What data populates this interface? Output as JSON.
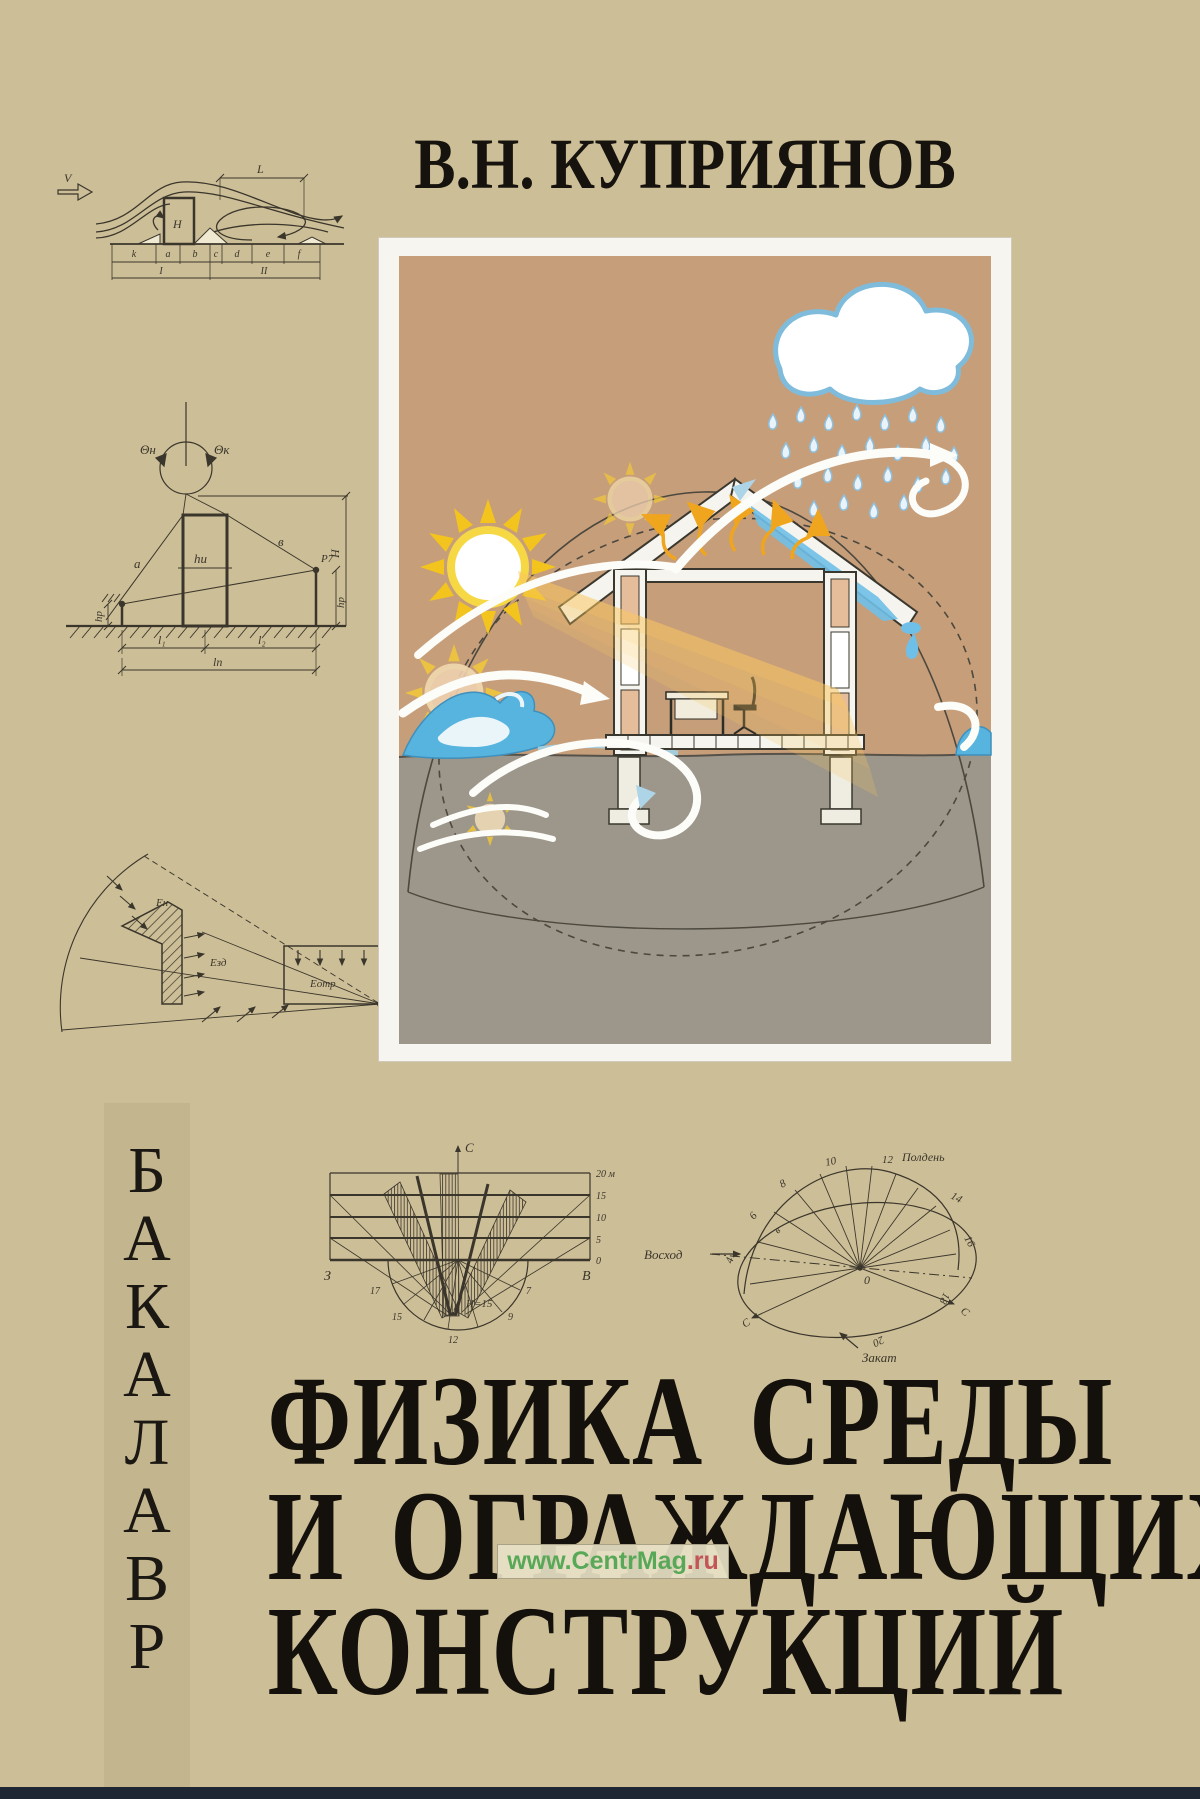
{
  "cover": {
    "author": "В.Н. КУПРИЯНОВ",
    "title_line1": "ФИЗИКА СРЕДЫ",
    "title_line2": "И ОГРАЖДАЮЩИХ",
    "title_line3": "КОНСТРУКЦИЙ",
    "spine_letters": [
      "Б",
      "А",
      "К",
      "А",
      "Л",
      "А",
      "В",
      "Р"
    ],
    "watermark_main": "www.CentrMag",
    "watermark_tld": ".ru",
    "colors": {
      "background": "#ccbe96",
      "spine_strip": "#c3b58d",
      "diagram_ink": "#3b362c",
      "title_ink": "#14100c",
      "illustration_sky": "#c79e7a",
      "illustration_ground": "#9d968a",
      "sun_yellow": "#f2c41d",
      "water_blue": "#57b4de",
      "cloud_outline": "#7fbcdc",
      "heat_orange": "#f0a51e",
      "watermark_green": "#58a858",
      "bottom_bar": "#1e2633"
    }
  },
  "wind_diagram": {
    "velocity": "V",
    "span": "L",
    "height": "H",
    "zones": [
      "k",
      "a",
      "b",
      "c",
      "d",
      "e",
      "f"
    ],
    "sections": [
      "I",
      "II"
    ]
  },
  "shadow_diagram": {
    "angle_start": "Θн",
    "angle_end": "Θк",
    "ray_a": "а",
    "ray_b": "в",
    "point": "Р7",
    "h_center": "hи",
    "h_left": "hр",
    "h_right": "hр",
    "len1": "l₁",
    "len2": "l₂",
    "len_total": "lп",
    "total_height": "Н"
  },
  "lux_diagram": {
    "sky": "Ен",
    "building": "Езд",
    "reflected": "Еотр",
    "point": "М"
  },
  "insolation_chart": {
    "north": "С",
    "west": "З",
    "east": "В",
    "scale": [
      "20 м",
      "15",
      "10",
      "5",
      "0"
    ],
    "hours": [
      "17",
      "15",
      "12",
      "9",
      "7"
    ],
    "height_note": "H=15"
  },
  "sunpath_chart": {
    "sunrise": "Восход",
    "sunset": "Закат",
    "noon_hour": "12",
    "noon": "Полдень",
    "hours": [
      "4",
      "6",
      "8",
      "10",
      "14",
      "16",
      "18",
      "20"
    ],
    "center": "0",
    "east": "в",
    "south_left": "С",
    "south_right": "С"
  }
}
